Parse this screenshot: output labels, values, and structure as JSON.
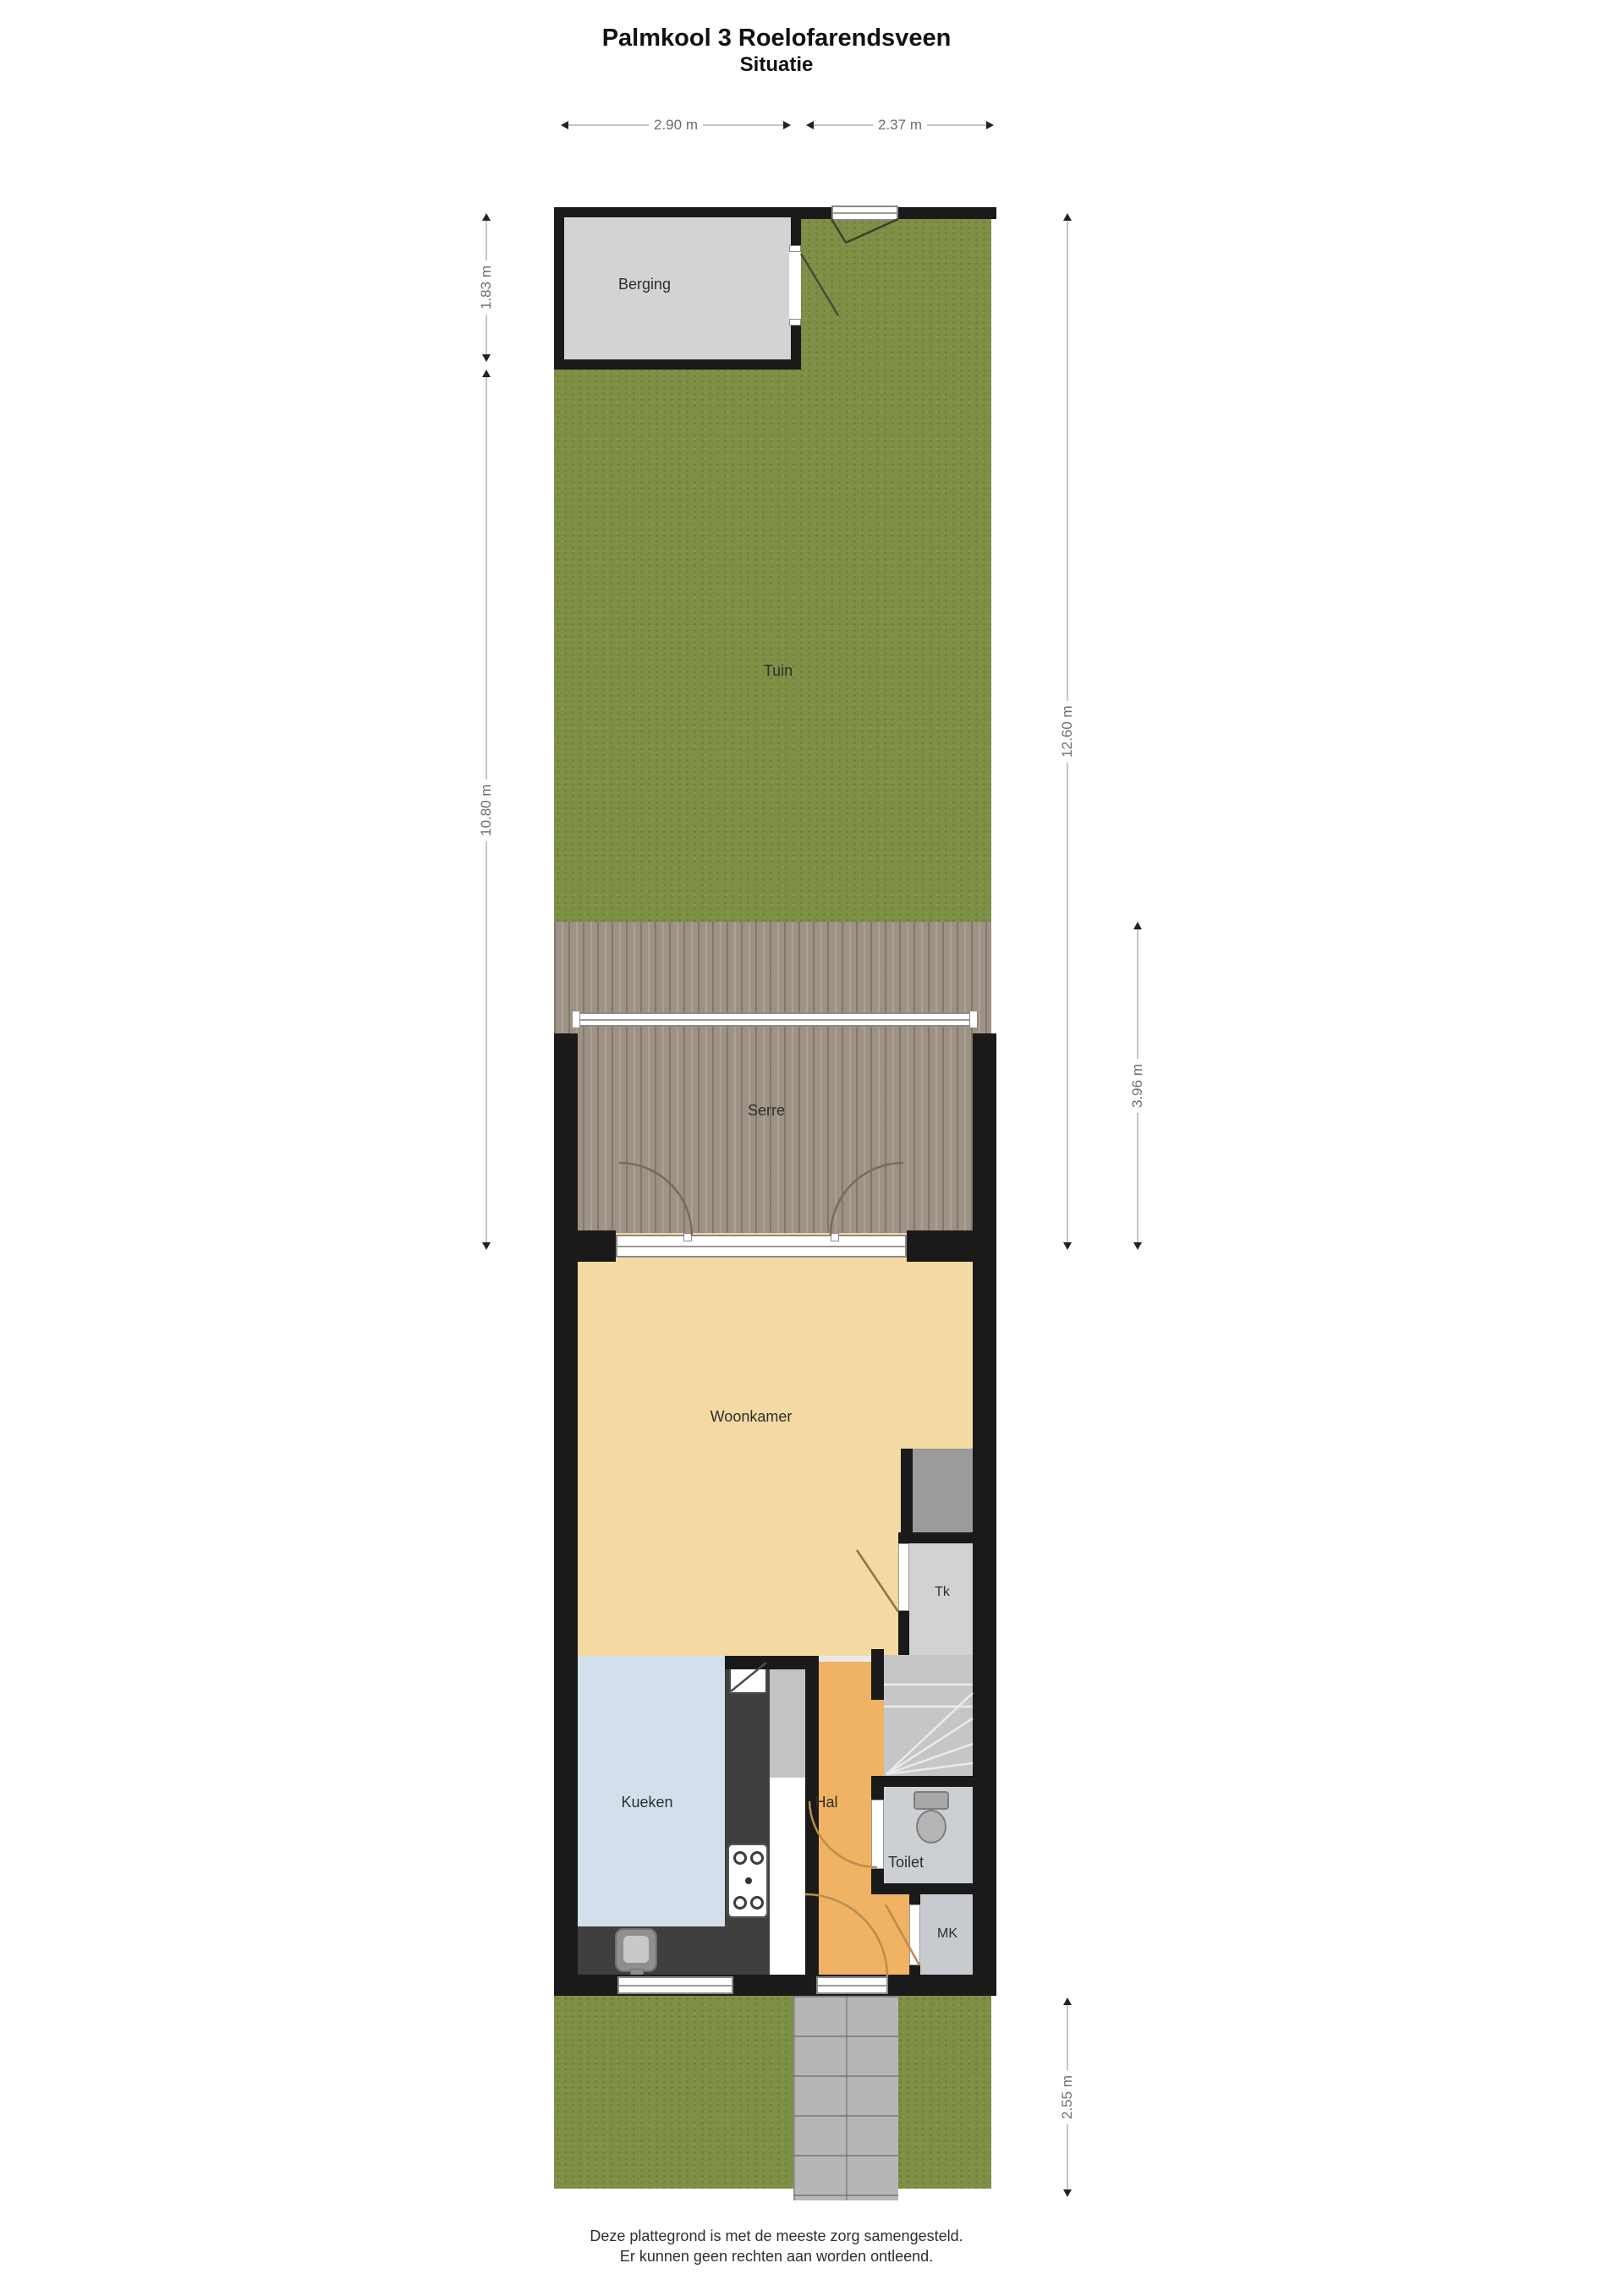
{
  "title": {
    "line1": "Palmkool 3 Roelofarendsveen",
    "line2": "Situatie"
  },
  "rooms": {
    "berging": "Berging",
    "tuin": "Tuin",
    "serre": "Serre",
    "woonkamer": "Woonkamer",
    "tk": "Tk",
    "keuken": "Kueken",
    "hal": "Hal",
    "toilet": "Toilet",
    "mk": "MK"
  },
  "dimensions": {
    "top_left": "2.90 m",
    "top_right": "2.37 m",
    "side_left_upper": "1.83 m",
    "side_left_lower": "10.80 m",
    "side_right_total": "12.60 m",
    "side_right_serre": "3.96 m",
    "side_right_front": "2.55 m"
  },
  "footer": {
    "line1": "Deze plattegrond is met de meeste zorg samengesteld.",
    "line2": "Er kunnen geen rechten aan worden ontleend."
  },
  "colors": {
    "grass": "#7e8f46",
    "decking": "#9d9285",
    "wall": "#1a1a1a",
    "berging_floor": "#d3d3d3",
    "woonkamer_floor": "#f4d9a3",
    "hal_floor": "#f0b263",
    "keuken_floor": "#d3e0ec",
    "toilet_floor": "#ccd0d4",
    "stairs_floor": "#c6c6c6",
    "kitchen_counter": "#3f3f3f",
    "paving": "#b6b6b6"
  }
}
